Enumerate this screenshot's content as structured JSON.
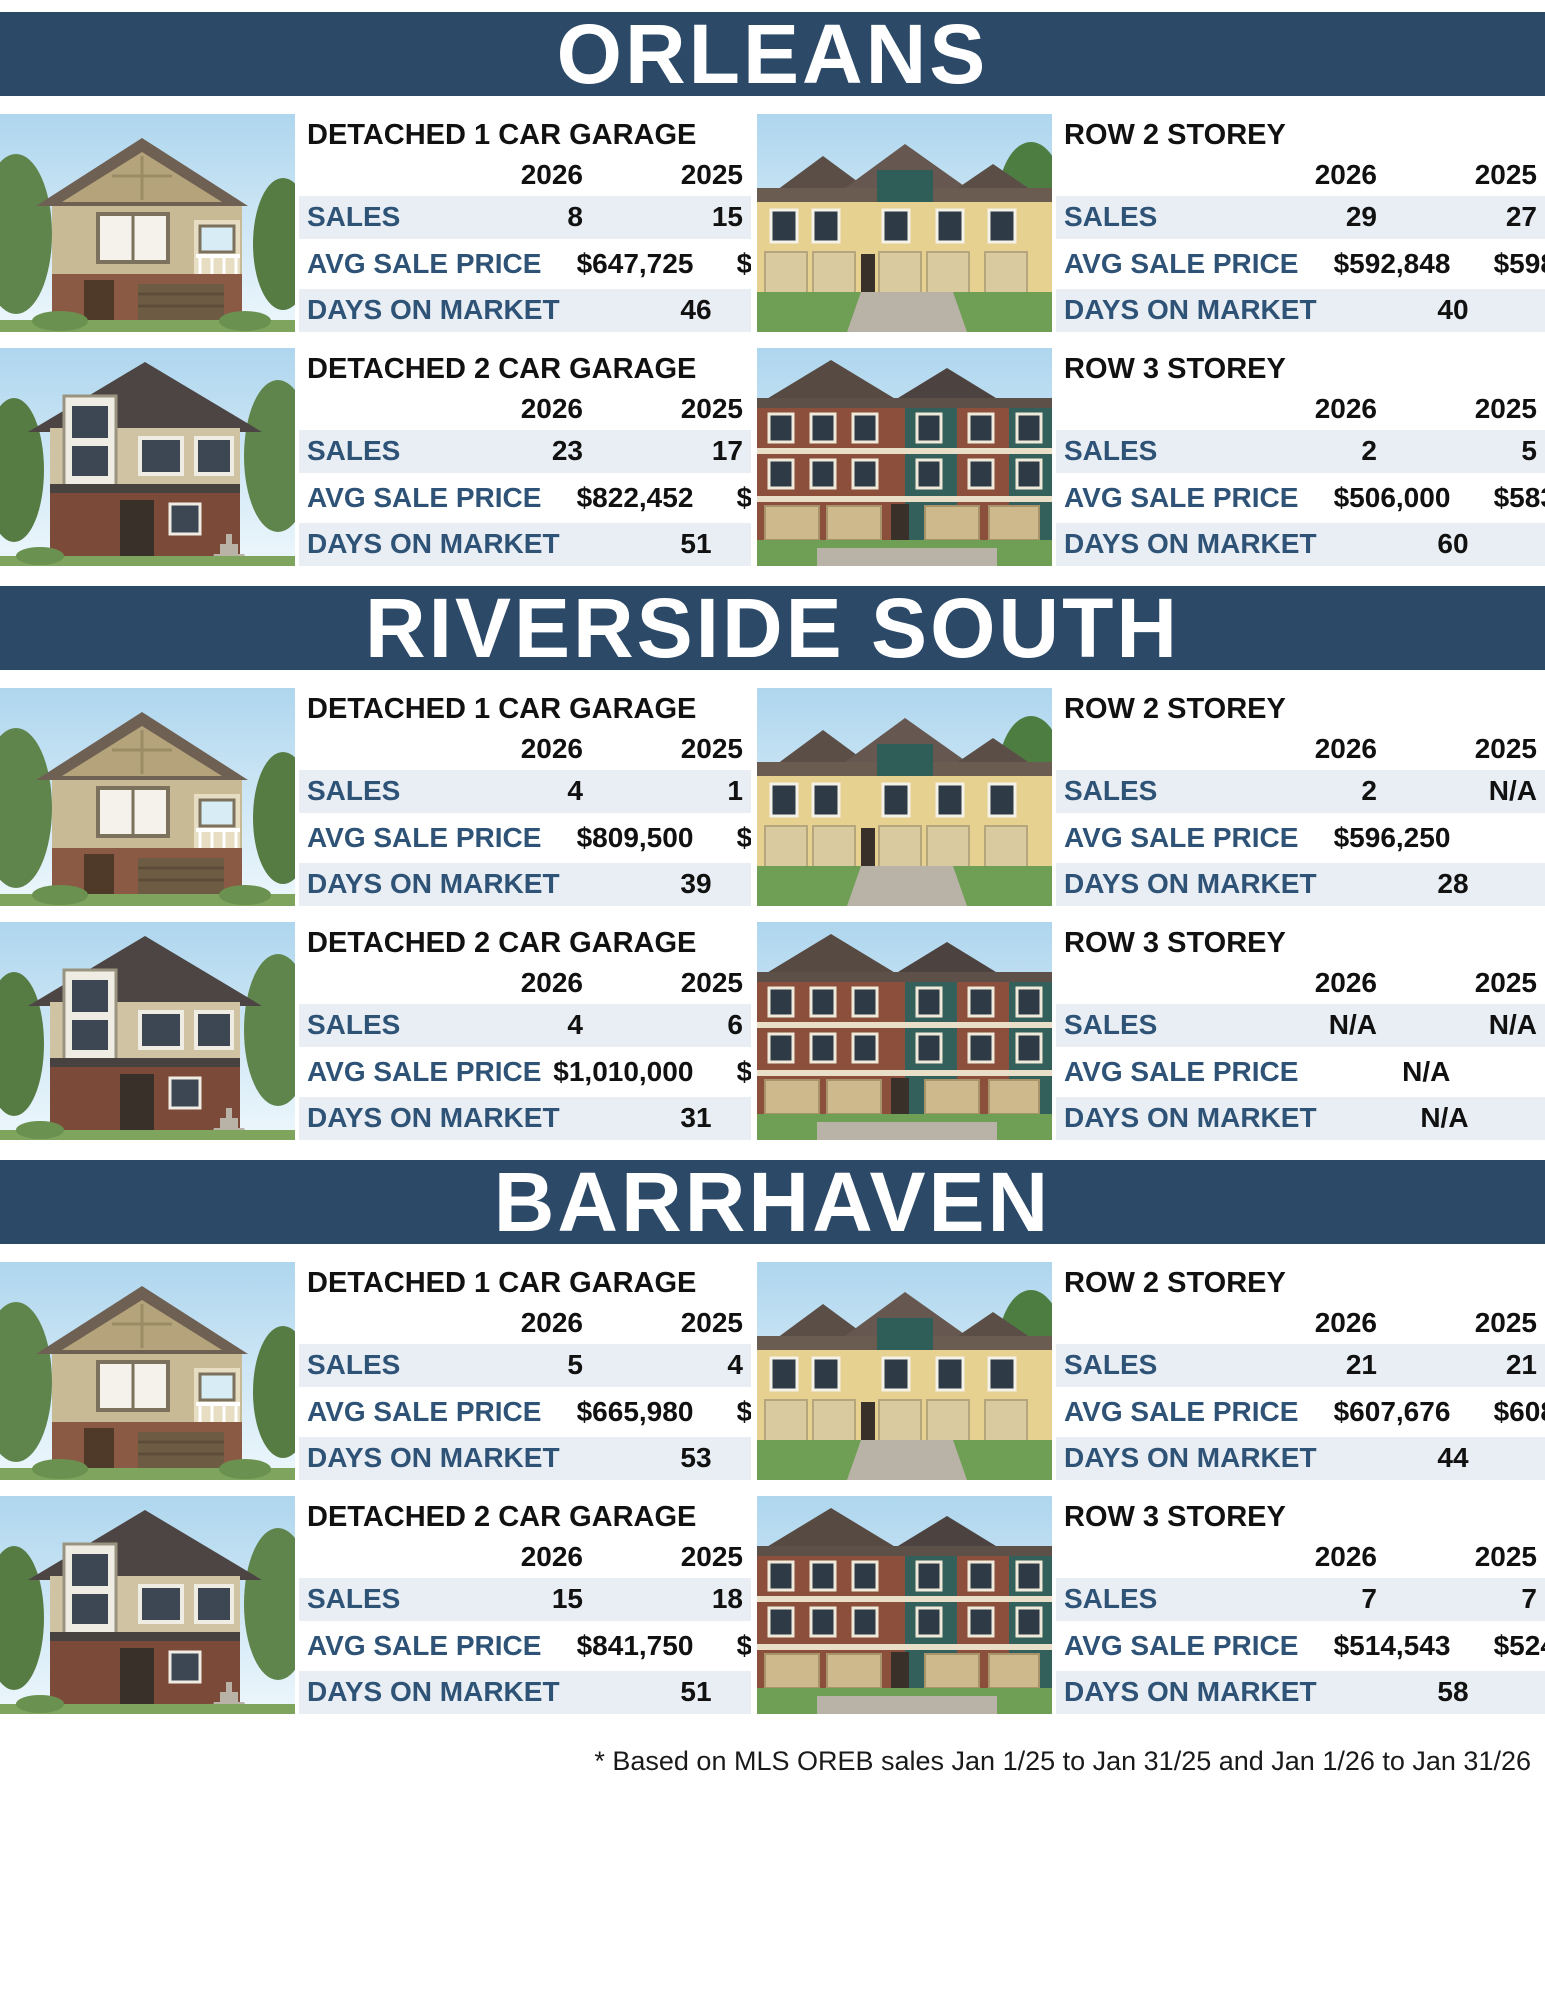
{
  "years": [
    "2026",
    "2025"
  ],
  "row_labels": {
    "sales": "SALES",
    "avg": "AVG SALE PRICE",
    "dom": "DAYS ON MARKET"
  },
  "footnote": "* Based on MLS OREB sales Jan 1/25 to Jan 31/25  and Jan 1/26 to Jan 31/26",
  "colors": {
    "banner_navy": "#2c4a68",
    "row_label_blue": "#2e5377",
    "row_band": "#e8eef3"
  },
  "sections": [
    {
      "title": "ORLEANS",
      "tables": [
        {
          "title": "DETACHED 1 CAR GARAGE",
          "house": "detached-1-car",
          "sales": [
            "8",
            "15"
          ],
          "avg": [
            "$647,725",
            "$647,273"
          ],
          "dom": [
            "46",
            "38"
          ]
        },
        {
          "title": "ROW 2 STOREY",
          "house": "row-2-storey",
          "sales": [
            "29",
            "27"
          ],
          "avg": [
            "$592,848",
            "$598,481"
          ],
          "dom": [
            "40",
            "46"
          ]
        },
        {
          "title": "DETACHED 2 CAR GARAGE",
          "house": "detached-2-car",
          "sales": [
            "23",
            "17"
          ],
          "avg": [
            "$822,452",
            "$767,912"
          ],
          "dom": [
            "51",
            "52"
          ]
        },
        {
          "title": "ROW 3 STOREY",
          "house": "row-3-storey",
          "sales": [
            "2",
            "5"
          ],
          "avg": [
            "$506,000",
            "$583,692"
          ],
          "dom": [
            "60",
            "76"
          ]
        }
      ]
    },
    {
      "title": "RIVERSIDE SOUTH",
      "tables": [
        {
          "title": "DETACHED 1 CAR GARAGE",
          "house": "detached-1-car",
          "sales": [
            "4",
            "1"
          ],
          "avg": [
            "$809,500",
            "$600,000"
          ],
          "dom": [
            "39",
            "50"
          ]
        },
        {
          "title": "ROW 2 STOREY",
          "house": "row-2-storey",
          "sales": [
            "2",
            "N/A"
          ],
          "avg": [
            "$596,250",
            "N/A"
          ],
          "dom": [
            "28",
            "N/A"
          ]
        },
        {
          "title": "DETACHED 2 CAR GARAGE",
          "house": "detached-2-car",
          "sales": [
            "4",
            "6"
          ],
          "avg": [
            "$1,010,000",
            "$899,317"
          ],
          "dom": [
            "31",
            "39"
          ]
        },
        {
          "title": "ROW 3 STOREY",
          "house": "row-3-storey",
          "sales": [
            "N/A",
            "N/A"
          ],
          "avg": [
            "N/A",
            "N/A"
          ],
          "dom": [
            "N/A",
            "N/A"
          ]
        }
      ]
    },
    {
      "title": "BARRHAVEN",
      "tables": [
        {
          "title": "DETACHED 1 CAR GARAGE",
          "house": "detached-1-car",
          "sales": [
            "5",
            "4"
          ],
          "avg": [
            "$665,980",
            "$697,500"
          ],
          "dom": [
            "53",
            "50"
          ]
        },
        {
          "title": "ROW 2 STOREY",
          "house": "row-2-storey",
          "sales": [
            "21",
            "21"
          ],
          "avg": [
            "$607,676",
            "$608,438"
          ],
          "dom": [
            "44",
            "52"
          ]
        },
        {
          "title": "DETACHED 2 CAR GARAGE",
          "house": "detached-2-car",
          "sales": [
            "15",
            "18"
          ],
          "avg": [
            "$841,750",
            "$932,203"
          ],
          "dom": [
            "51",
            "47"
          ]
        },
        {
          "title": "ROW 3 STOREY",
          "house": "row-3-storey",
          "sales": [
            "7",
            "7"
          ],
          "avg": [
            "$514,543",
            "$524,400"
          ],
          "dom": [
            "58",
            "24"
          ]
        }
      ]
    }
  ]
}
